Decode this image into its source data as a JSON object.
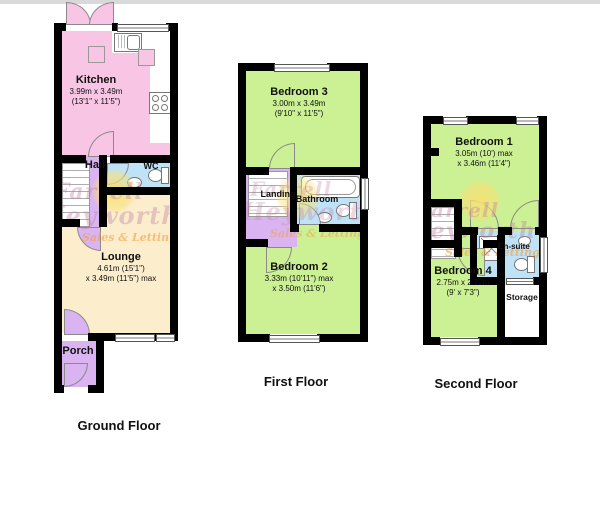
{
  "watermark": {
    "line1": "Farrell",
    "line2": "Heyworth",
    "line3": "Sales & Lettings"
  },
  "floors": {
    "ground": {
      "label": "Ground Floor",
      "rooms": {
        "kitchen": {
          "name": "Kitchen",
          "dim1": "3.99m x 3.49m",
          "dim2": "(13'1\" x 11'5\")"
        },
        "hall": {
          "name": "Hall"
        },
        "wc": {
          "name": "WC"
        },
        "lounge": {
          "name": "Lounge",
          "dim1": "4.61m (15'1\")",
          "dim2": "x 3.49m (11'5\") max"
        },
        "porch": {
          "name": "Porch"
        }
      }
    },
    "first": {
      "label": "First Floor",
      "rooms": {
        "bedroom3": {
          "name": "Bedroom 3",
          "dim1": "3.00m x 3.49m",
          "dim2": "(9'10\" x 11'5\")"
        },
        "landing": {
          "name": "Landing"
        },
        "bathroom": {
          "name": "Bathroom"
        },
        "bedroom2": {
          "name": "Bedroom 2",
          "dim1": "3.33m (10'11\") max",
          "dim2": "x 3.50m (11'6\")"
        }
      }
    },
    "second": {
      "label": "Second Floor",
      "rooms": {
        "bedroom1": {
          "name": "Bedroom 1",
          "dim1": "3.05m (10') max",
          "dim2": "x 3.46m (11'4\")"
        },
        "ensuite": {
          "name": "En-suite"
        },
        "bedroom4": {
          "name": "Bedroom 4",
          "dim1": "2.75m x 2.22m",
          "dim2": "(9' x 7'3\")"
        },
        "storage": {
          "name": "Storage"
        }
      }
    }
  },
  "colors": {
    "wall": "#000000",
    "kitchen_pink": "#f8c5e4",
    "hall_lavender": "#d9b4f0",
    "bath_blue": "#bfe2f6",
    "bedroom_green": "#ccf094",
    "lounge_cream": "#fcedcd",
    "storage_white": "#ffffff",
    "watermark_pink": "#ba7d9e",
    "watermark_orange": "#f39d3e",
    "sun_yellow": "#f9e074"
  }
}
